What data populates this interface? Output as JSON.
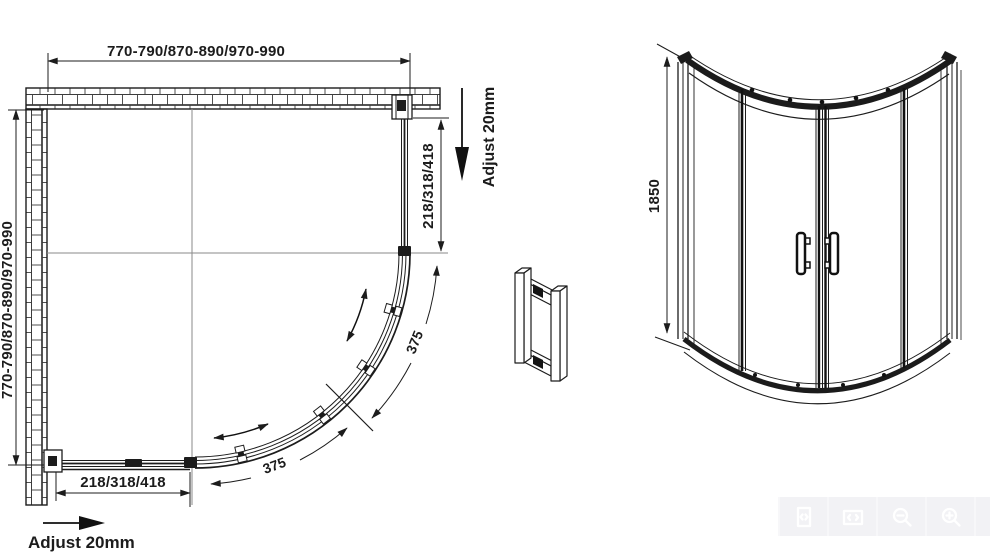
{
  "drawing": {
    "plan": {
      "width_dim": "770-790/870-890/970-990",
      "height_dim": "770-790/870-890/970-990",
      "panel_dim_vertical": "218/318/418",
      "panel_dim_horizontal": "218/318/418",
      "adjust_right_label": "Adjust 20mm",
      "adjust_bottom_label": "Adjust 20mm",
      "door_width_outer": "375",
      "door_width_inner": "375"
    },
    "elevation": {
      "height_dim": "1850"
    },
    "colors": {
      "line": "#1c1c1c",
      "centerline": "#8a8a8a"
    }
  },
  "viewer_toolbar": {
    "background": "#f7f7f9",
    "icon_color": "#ffffff",
    "buttons": [
      {
        "icon": "expand-icon"
      },
      {
        "icon": "fit-width-icon"
      },
      {
        "icon": "zoom-out-icon"
      },
      {
        "icon": "zoom-in-icon"
      }
    ]
  }
}
